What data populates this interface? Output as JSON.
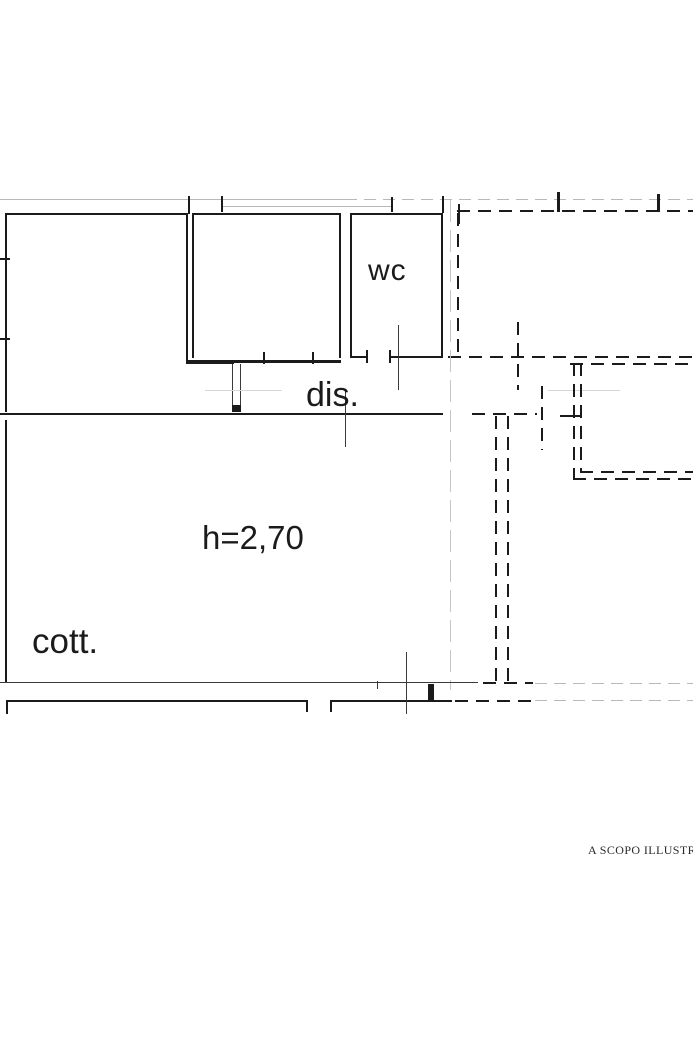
{
  "meta": {
    "type": "architectural-floor-plan",
    "language": "it"
  },
  "colors": {
    "wall": "#1b1b1b",
    "guide": "#b8b8b8",
    "faint": "#d6d6d6",
    "center_axis": "#c6c6c6",
    "background": "#ffffff",
    "disclaimer_text": "#2a2a2a"
  },
  "labels": {
    "wc": "wc",
    "dis": "dis.",
    "height_note": "h=2,70",
    "cott": "cott.",
    "disclaimer": "A SCOPO ILLUSTRAT"
  }
}
